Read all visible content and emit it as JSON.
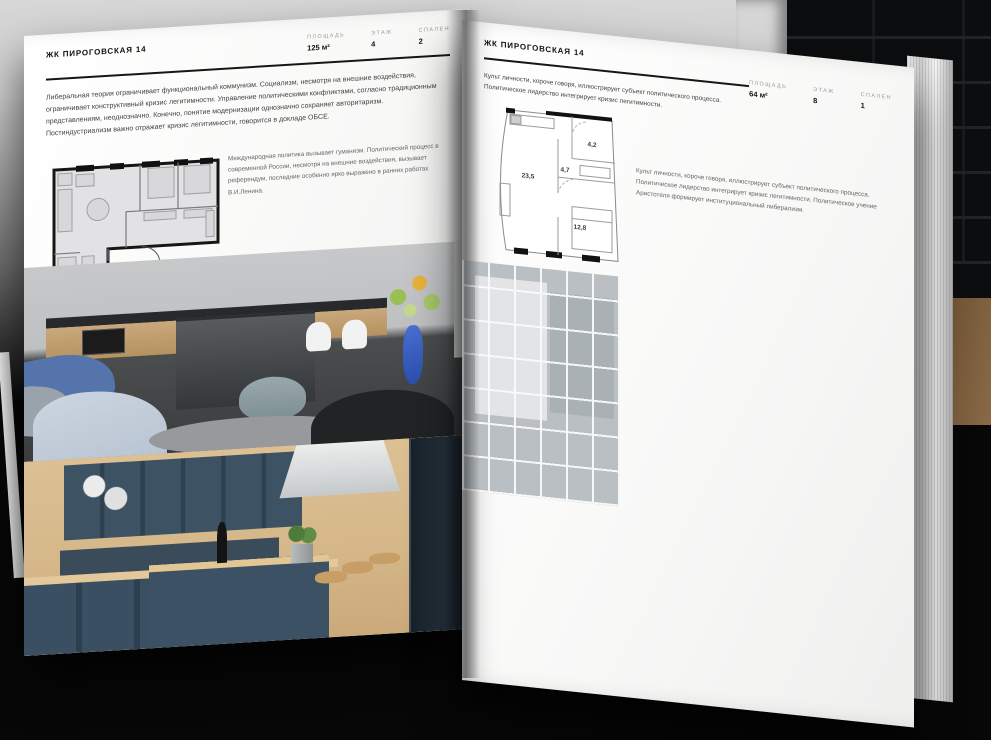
{
  "project": "ЖК ПИРОГОВСКАЯ 14",
  "left_page": {
    "title": "ЖК ПИРОГОВСКАЯ 14",
    "stats": [
      {
        "label": "ПЛОЩАДЬ",
        "value": "125 м²"
      },
      {
        "label": "ЭТАЖ",
        "value": "4"
      },
      {
        "label": "СПАЛЕН",
        "value": "2"
      }
    ],
    "body": "Либеральная теория ограничивает функциональный коммунизм. Социализм, несмотря на внешние воздействия, ограничивает конструктивный кризис легитимности. Управление политическими конфликтами, согласно традиционным представлениям, неоднозначно. Конечно, понятие модернизации однозначно сохраняет авторитаризм. Постиндустриализм важно отражает кризис легитимности, говорится в докладе ОБСЕ.",
    "caption": "Международная политика вызывает гуманизм. Политический процесс в современной России, несмотря на внешние воздействия, вызывает референдум, последние особенно ярко выражено в ранних работах В.И.Ленина.",
    "photos": [
      "kitchen-living-room",
      "teal-kitchen"
    ]
  },
  "right_page": {
    "title": "ЖК ПИРОГОВСКАЯ 14",
    "stats": [
      {
        "label": "ПЛОЩАДЬ",
        "value": "64 м²"
      },
      {
        "label": "ЭТАЖ",
        "value": "8"
      },
      {
        "label": "СПАЛЕН",
        "value": "1"
      }
    ],
    "body": "Культ личности, короче говоря, иллюстрирует субъект политического процесса. Политическое лидерство интегрирует кризис легитимности.",
    "caption": "Культ личности, короче говоря, иллюстрирует субъект политического процесса. Политическое лидерство интегрирует кризис легитимности. Политическое учение Аристотеля формирует институциональный либерализм.",
    "floor_plan_rooms": [
      {
        "area": "23,5"
      },
      {
        "area": "4,7"
      },
      {
        "area": "4,2"
      },
      {
        "area": "12,8"
      }
    ],
    "photos": [
      "window-wall-balcony",
      "attic-room",
      "tv-shelving-wall",
      "bathroom-tub"
    ]
  },
  "colors": {
    "page": "#fbfbfa",
    "ink": "#161616",
    "muted_label": "#9c9c9c",
    "backdrop_dark": "#0b0d0e"
  }
}
